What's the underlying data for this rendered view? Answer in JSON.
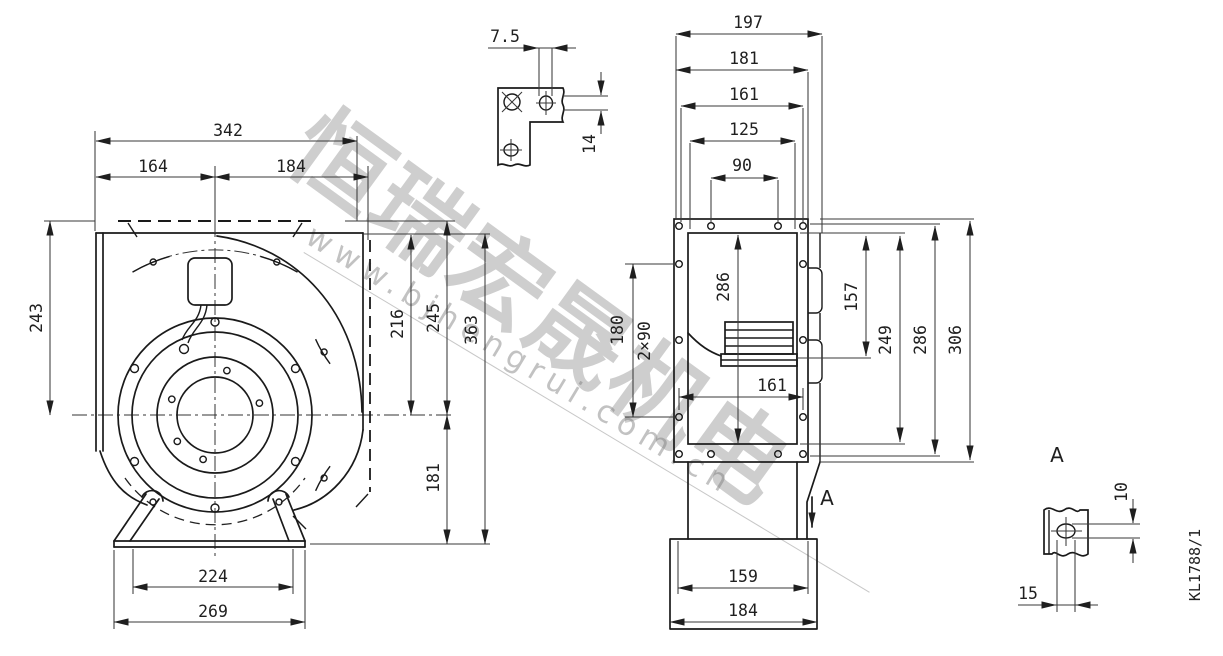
{
  "watermark": {
    "cjk_text": "恒瑞宏晟机电",
    "url_text": "www.bjhengrui.com.cn"
  },
  "drawing_code": "KL1788/1",
  "front_view": {
    "d342": "342",
    "d164": "164",
    "d184": "184",
    "d243": "243",
    "d216": "216",
    "d245": "245",
    "d363": "363",
    "d181": "181",
    "d224": "224",
    "d269": "269"
  },
  "bracket_detail": {
    "d7_5": "7.5",
    "d14": "14"
  },
  "side_view": {
    "d197": "197",
    "d181": "181",
    "d161_top": "161",
    "d125": "125",
    "d90": "90",
    "d286_inner": "286",
    "d180": "180",
    "d2x90": "2×90",
    "d161_inner": "161",
    "d157": "157",
    "d249": "249",
    "d286_right": "286",
    "d306": "306",
    "d159": "159",
    "d184": "184",
    "section_label": "A"
  },
  "detail_a": {
    "view_label": "A",
    "d10": "10",
    "d15": "15"
  }
}
